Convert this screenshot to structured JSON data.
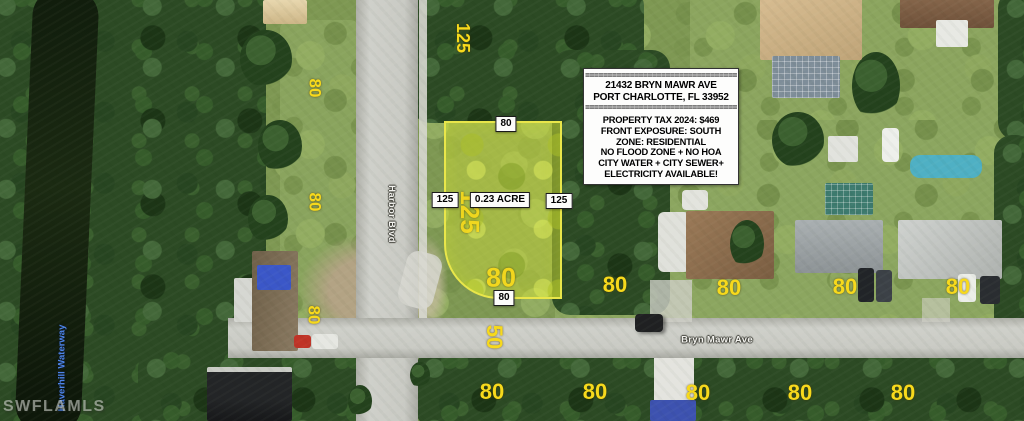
{
  "watermark": "SWFLAMLS",
  "streets": {
    "vertical": "Harbor Blvd",
    "horizontal": "Bryn Mawr Ave"
  },
  "waterway_label": "Haverhill Waterway",
  "info_box": {
    "separator_top": "==================================",
    "address_line1": "21432 BRYN MAWR AVE",
    "address_line2": "PORT CHARLOTTE, FL 33952",
    "separator_mid": "==================================",
    "details": [
      "PROPERTY TAX 2024: $469",
      "FRONT EXPOSURE: SOUTH",
      "ZONE: RESIDENTIAL",
      "NO FLOOD ZONE + NO HOA",
      "CITY WATER + CITY SEWER+",
      "ELECTRICITY AVAILABLE!"
    ]
  },
  "lot": {
    "area": "0.23 ACRE",
    "frontage_top": "80",
    "depth_left": "125",
    "depth_right": "125",
    "frontage_bottom": "80",
    "inner_depth": "125",
    "inner_frontage": "80"
  },
  "yellow_dims": [
    "80",
    "125",
    "80",
    "80",
    "125",
    "80",
    "50",
    "80",
    "80",
    "80",
    "80",
    "80",
    "80",
    "80",
    "80",
    "80"
  ],
  "colors": {
    "dimension_yellow": "#f7d91c",
    "lot_outline": "#e9e64a",
    "lot_fill": "rgba(210,224,58,0.45)",
    "waterway_text": "#4d84e8",
    "street_text": "#f2f2ee"
  }
}
